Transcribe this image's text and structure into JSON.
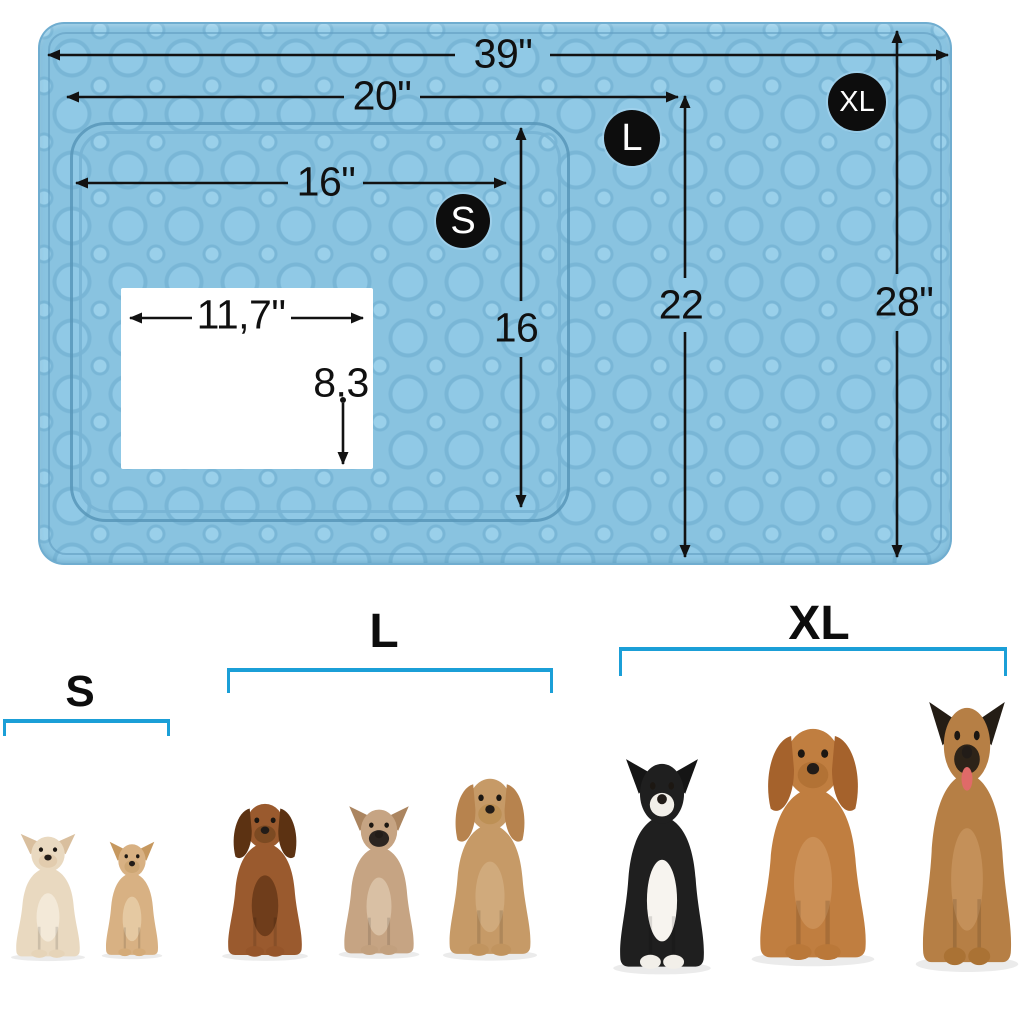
{
  "colors": {
    "background": "#ffffff",
    "mat_base": "#89c3e0",
    "mat_cell": "#90c9e6",
    "mat_cell_small": "#9ad0ea",
    "mat_seam": "#79b6d6",
    "mat_edge": "#6fadd0",
    "line_black": "#121212",
    "text_black": "#101010",
    "badge_bg": "#0d0d0d",
    "badge_text": "#ffffff",
    "bracket_blue": "#1b9fd7"
  },
  "dimensions": {
    "xl_width": "39\"",
    "l_width": "20\"",
    "s_width": "16\"",
    "window_width": "11,7\"",
    "window_height": "8.3",
    "s_height": "16",
    "l_height": "22",
    "xl_height": "28\""
  },
  "badges": {
    "s": "S",
    "l": "L",
    "xl": "XL"
  },
  "size_groups": [
    {
      "label": "S",
      "dogs": [
        {
          "name": "chihuahua-cream",
          "colors": {
            "body": "#e9d9c0",
            "ear": "#d9bf9e",
            "muzzle": "#e2ccae",
            "chest": "#f3e9d8",
            "paws": "#e6d4b8"
          }
        },
        {
          "name": "chihuahua-tan",
          "colors": {
            "body": "#d8b183",
            "ear": "#c6985f",
            "muzzle": "#cda674",
            "chest": "#e5c9a2",
            "paws": "#d4ab79"
          }
        }
      ]
    },
    {
      "label": "L",
      "dogs": [
        {
          "name": "dachshund-longhaired",
          "colors": {
            "body": "#9a5a2e",
            "ear": "#5c3212",
            "muzzle": "#7c4a22",
            "chest": "#6f3d1b",
            "paws": "#95552a"
          }
        },
        {
          "name": "french-bulldog",
          "colors": {
            "body": "#c6a483",
            "ear": "#ab8560",
            "muzzle": "#2b2420",
            "chest": "#d9c0a4",
            "paws": "#c2a07e"
          }
        },
        {
          "name": "cockapoo-apricot",
          "colors": {
            "body": "#c69a67",
            "ear": "#b7834e",
            "muzzle": "#bd9055",
            "chest": "#d0aa7c",
            "paws": "#c1945f"
          }
        }
      ]
    },
    {
      "label": "XL",
      "dogs": [
        {
          "name": "border-collie",
          "colors": {
            "body": "#1f1f1f",
            "ear": "#151515",
            "muzzle": "#f2efe9",
            "chest": "#f7f4ef",
            "paws": "#f2efe9"
          }
        },
        {
          "name": "labrador-fox-red",
          "colors": {
            "body": "#c07e40",
            "ear": "#a5622c",
            "muzzle": "#b27235",
            "chest": "#cb8f55",
            "paws": "#ba7839"
          }
        },
        {
          "name": "german-shepherd",
          "colors": {
            "body": "#b67f45",
            "ear": "#241d15",
            "muzzle": "#2d2318",
            "chest": "#c49059",
            "paws": "#aa7234",
            "tongue": "#e06a68"
          }
        }
      ]
    }
  ]
}
